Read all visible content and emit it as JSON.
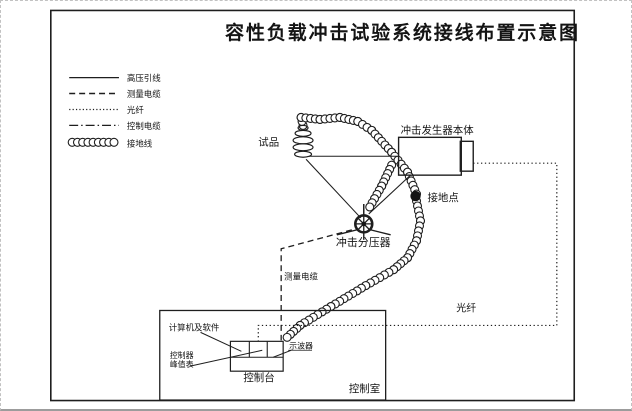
{
  "title": "容性负载冲击试验系统接线布置示意图",
  "legend": {
    "items": [
      {
        "label": "高压引线",
        "line_style": "solid"
      },
      {
        "label": "测量电缆",
        "line_style": "dashed"
      },
      {
        "label": "光纤",
        "line_style": "dotted"
      },
      {
        "label": "控制电缆",
        "line_style": "dash-dot"
      },
      {
        "label": "接地线",
        "line_style": "coil"
      }
    ]
  },
  "nodes": {
    "specimen": "试品",
    "impulse_generator": "冲击发生器本体",
    "ground_point": "接地点",
    "impulse_divider": "冲击分压器",
    "measuring_cable": "测量电缆",
    "fiber": "光纤",
    "computer_software": "计算机及软件",
    "controller": "控制器",
    "peak_meter": "峰值表",
    "oscilloscope": "示波器",
    "console": "控制台",
    "control_room": "控制室"
  },
  "colors": {
    "ink": "#1e1e1e",
    "background": "#ffffff"
  }
}
